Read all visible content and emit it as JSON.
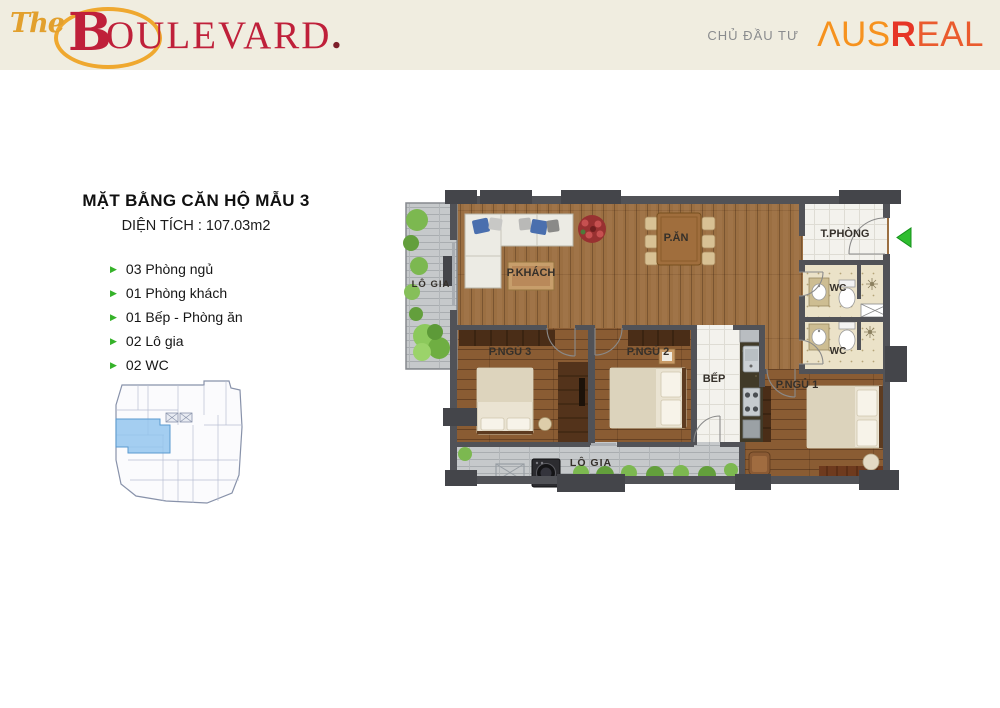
{
  "header": {
    "bg_color": "#f0ede0",
    "logo": {
      "the": "The",
      "b": "B",
      "name_rest": "OULEVARD",
      "dot": ".",
      "gold": "#efa82f",
      "red": "#bf203a"
    },
    "developer": {
      "label": "CHỦ ĐẦU TƯ",
      "brand_aus": "ΛUS",
      "brand_r": "R",
      "brand_eal": "EAL",
      "orange": "#f6921e",
      "red": "#e63526"
    }
  },
  "info": {
    "title": "MẶT BẰNG CĂN HỘ MẪU 3",
    "area": "DIỆN TÍCH : 107.03m2",
    "features": [
      "03 Phòng ngủ",
      "01 Phòng khách",
      "01 Bếp - Phòng ăn",
      "02 Lô gia",
      "02 WC"
    ],
    "bullet_color": "#35b229"
  },
  "keyplan": {
    "highlight_color": "#8fc3ee",
    "outline_color": "#8892aa"
  },
  "floorplan": {
    "labels": {
      "logia_left": "LÔ GIA",
      "pkhach": "P.KHÁCH",
      "pan": "P.ĂN",
      "tphong": "T.PHÒNG",
      "wc1": "WC",
      "wc2": "WC",
      "pngu3": "P.NGỦ 3",
      "pngu2": "P.NGỦ 2",
      "bep": "BẾP",
      "pngu1": "P.NGỦ 1",
      "logia_bottom": "LÔ GIA"
    },
    "colors": {
      "wall": "#515257",
      "pillar": "#44454a",
      "wood": "#9b6f42",
      "wood_dark": "#8a5c33",
      "deck": "#c6c9cb",
      "tile": "#f3f2ed",
      "wc_tile": "#ebe2c8",
      "plant": "#7cb850",
      "entry_arrow": "#2fbe2f"
    }
  }
}
